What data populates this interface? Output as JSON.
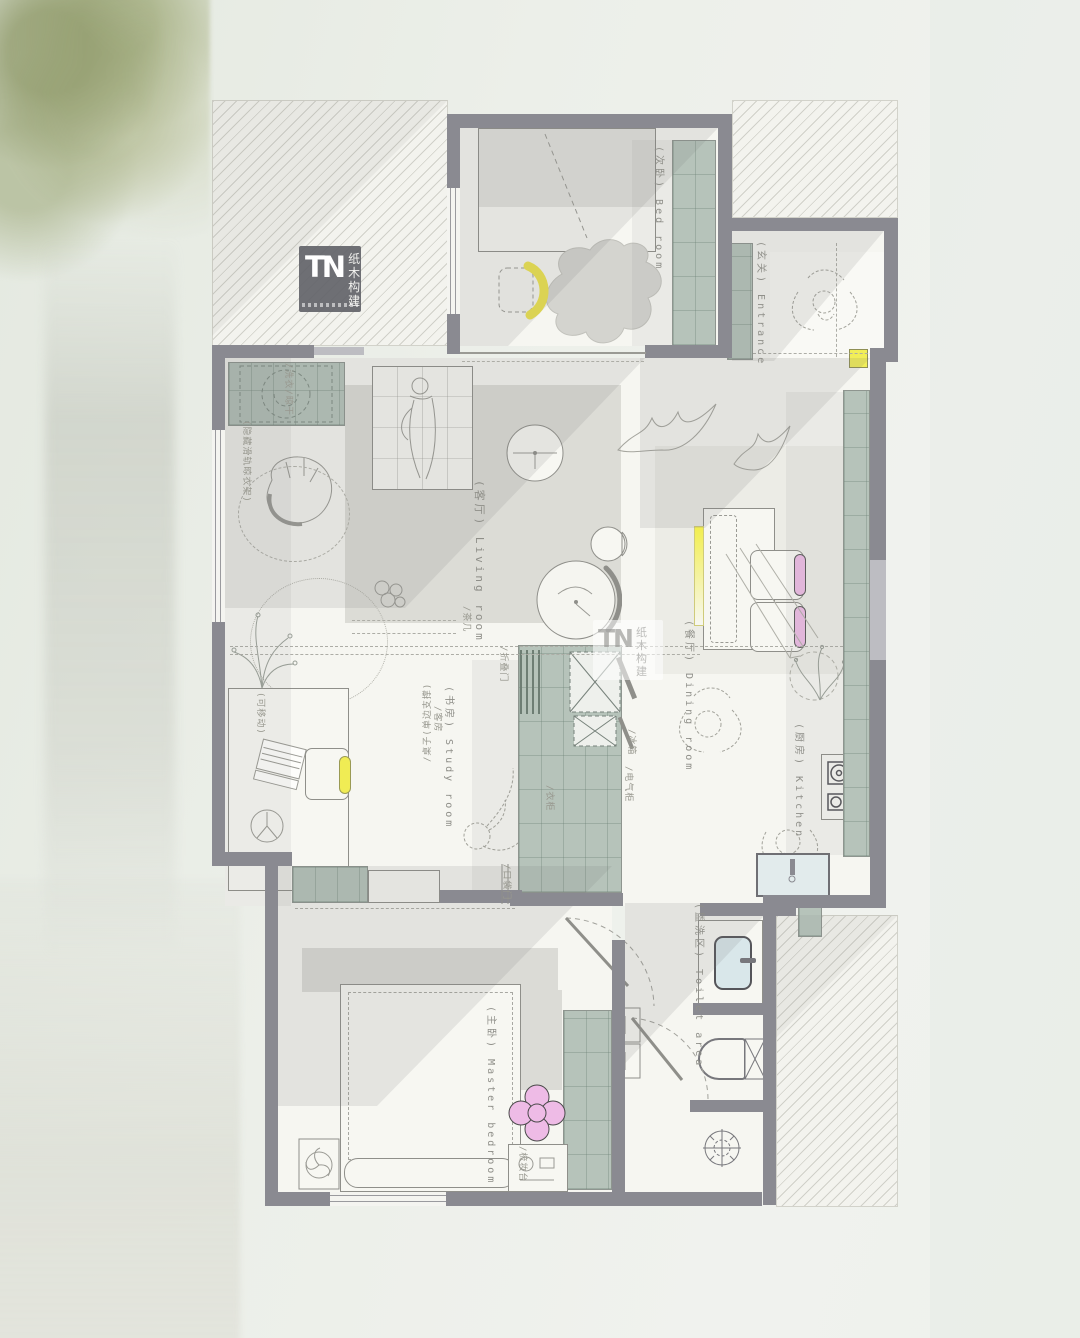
{
  "branding": {
    "logo_initials": "TN",
    "logo_cn_top": "纸木",
    "logo_cn_bottom": "构建"
  },
  "watermark": {
    "initials": "TN",
    "cn_top": "纸木",
    "cn_bottom": "构建"
  },
  "rooms": [
    {
      "id": "bedroom",
      "label": "(次卧) Bed room"
    },
    {
      "id": "entrance",
      "label": "(玄关) Entrance"
    },
    {
      "id": "living-room",
      "label": "(客厅) Living room"
    },
    {
      "id": "dining-room",
      "label": "(餐厅) Dining room"
    },
    {
      "id": "kitchen",
      "label": "(厨房) Kitchen"
    },
    {
      "id": "study-room",
      "label": "(书房) Study room"
    },
    {
      "id": "toilet-area",
      "label": "(盥洗区) Toilet area"
    },
    {
      "id": "master-bedroom",
      "label": "(主卧) Master bedroom"
    }
  ],
  "annotations": [
    {
      "id": "wash-dry",
      "text": "/洗衣/晾干"
    },
    {
      "id": "hidden-rail-rack",
      "text": "(隐藏滑轨晾衣架)"
    },
    {
      "id": "desk-single-support",
      "text": "/桌子(单边支撑)"
    },
    {
      "id": "movable",
      "text": "(可移动)"
    },
    {
      "id": "guest-room",
      "text": "/客房"
    },
    {
      "id": "tea-table",
      "text": "/茶几"
    },
    {
      "id": "folding-door",
      "text": "/折叠门"
    },
    {
      "id": "fridge",
      "text": "/冰箱"
    },
    {
      "id": "electrical-cabinet",
      "text": "/电气柜"
    },
    {
      "id": "wardrobe",
      "text": "/衣柜"
    },
    {
      "id": "pocket-door",
      "text": "/口袋门"
    },
    {
      "id": "dressing-table",
      "text": "/梳妆台"
    }
  ],
  "colors": {
    "wall": "#8a8a91",
    "cabinet": "#b6c3ba",
    "accent_yellow": "#f0ec55",
    "accent_pink": "#ecbce4",
    "accent_blue": "#d9e7ea",
    "label_text": "#8f8f89"
  }
}
